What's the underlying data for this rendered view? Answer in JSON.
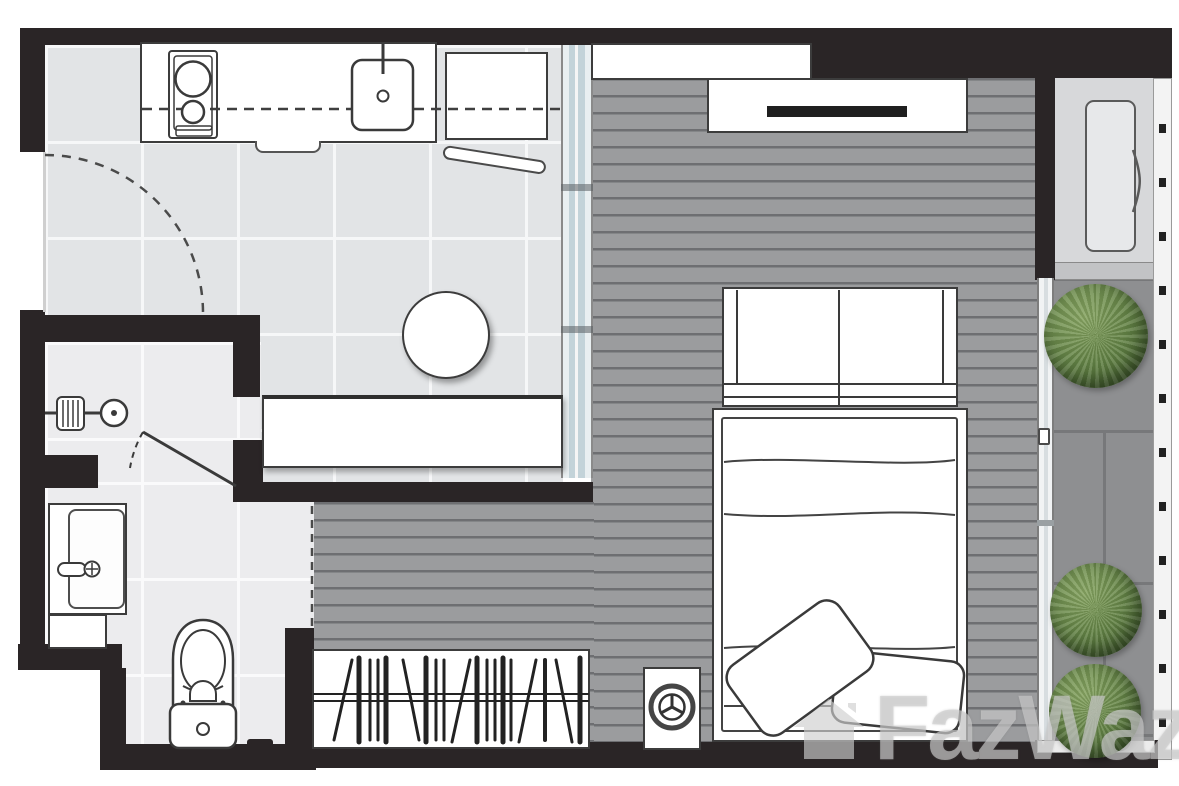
{
  "watermark": {
    "icon": "house-icon",
    "text": "FazWaz"
  },
  "palette": {
    "wall": "#2a2526",
    "kitchen_tile": "#e2e4e6",
    "bathroom_tile": "#ececee",
    "wood_floor": "#9b9c9e",
    "balcony_floor": "#8e8f91",
    "ac_ledge_floor": "#d7d8da",
    "glass_partition": "#cfdbe0",
    "plant_green": "#5d7d41",
    "fixture_outline": "#3a3a3a",
    "furniture_fill": "#ffffff"
  },
  "rooms": [
    {
      "name": "kitchen-foyer",
      "floor": "ceramic-tile"
    },
    {
      "name": "bathroom",
      "floor": "ceramic-tile"
    },
    {
      "name": "sleeping-living-area",
      "floor": "wood-plank"
    },
    {
      "name": "balcony",
      "floor": "stone-tile"
    },
    {
      "name": "ac-ledge",
      "floor": "concrete"
    }
  ],
  "fixtures": [
    "entry-door-swing",
    "kitchen-counter",
    "stove-icon",
    "kitchen-sink-icon",
    "overhead-cabinet-line",
    "refrigerator-icon",
    "fridge-door",
    "round-table",
    "bench-counter",
    "sliding-glass-partition",
    "shower-icon",
    "shower-door",
    "vanity-sink-icon",
    "vanity-cabinet",
    "toilet-icon",
    "door-stop",
    "wall-shelf",
    "tv-console",
    "tv",
    "wardrobe",
    "double-bed",
    "pillow",
    "pillow",
    "clothes-rack",
    "washing-machine-icon",
    "balcony-sliding-door",
    "balcony-railing",
    "ac-unit-icon",
    "plant",
    "plant",
    "plant"
  ]
}
